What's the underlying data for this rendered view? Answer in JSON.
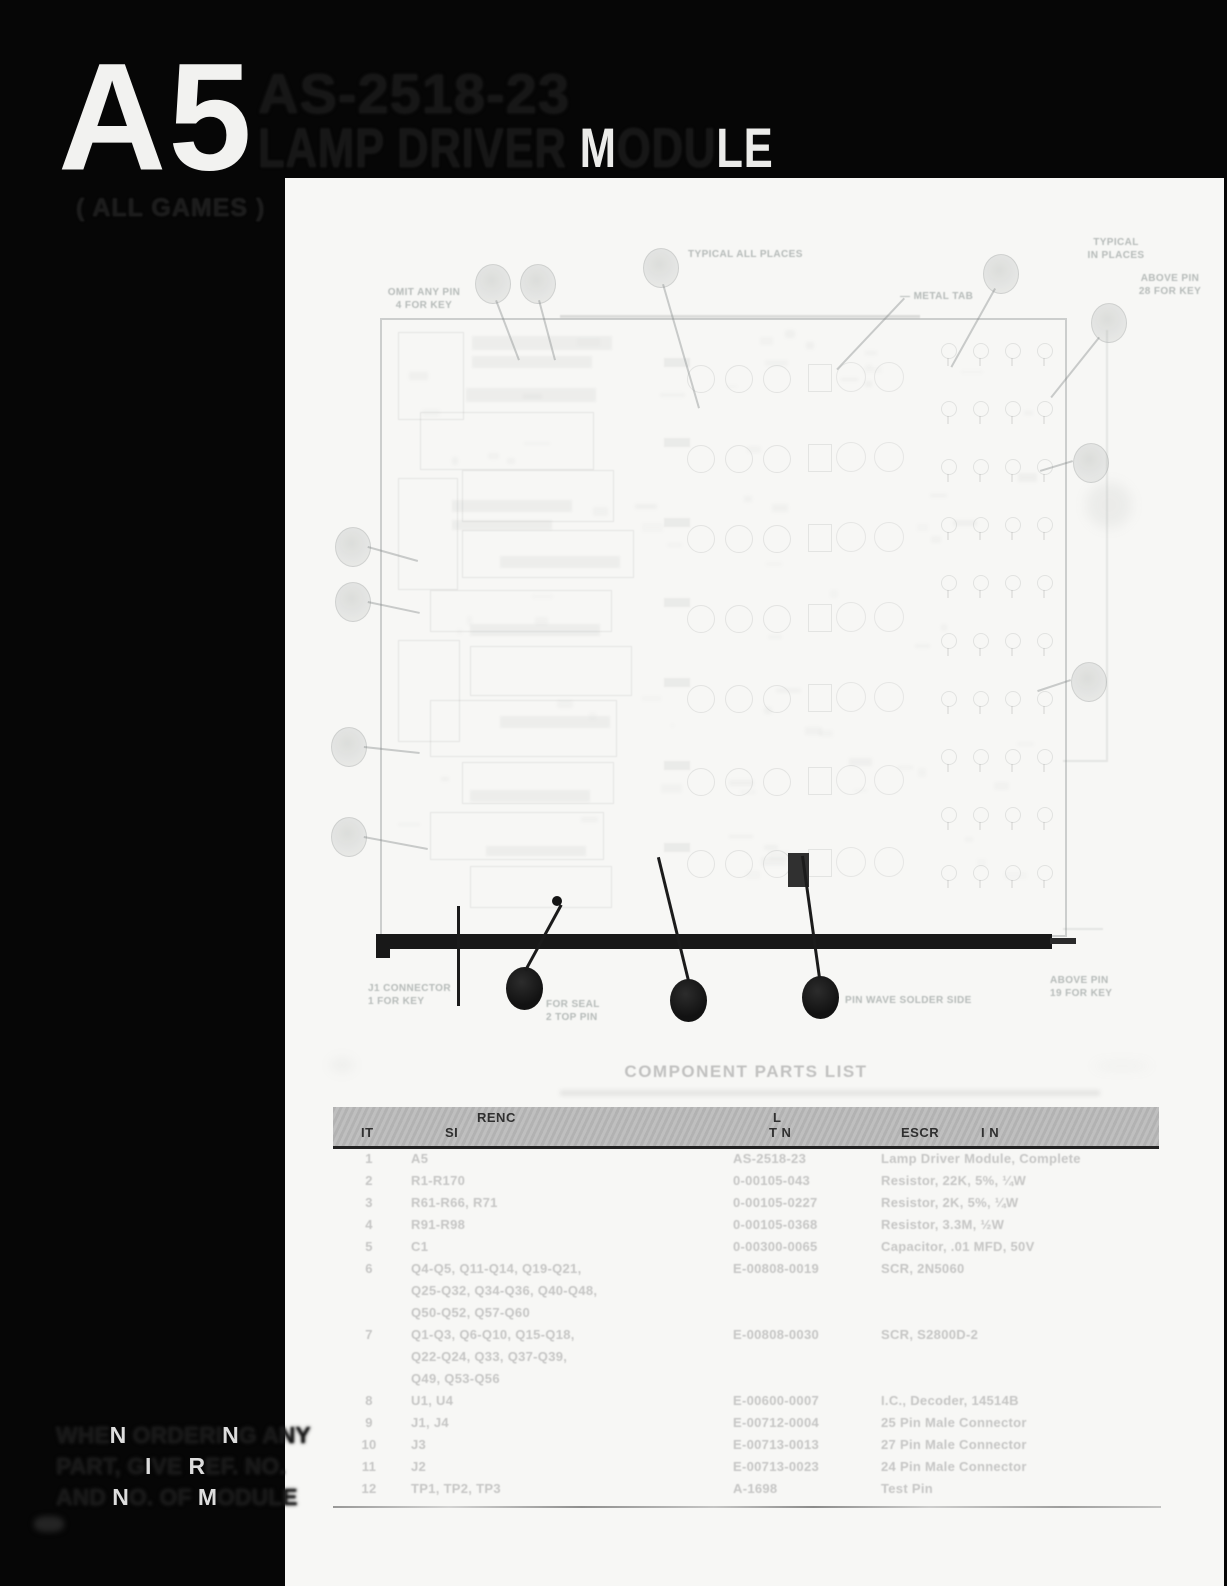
{
  "header": {
    "module_id": "A5",
    "title_line1": "AS-2518-23",
    "title_line2_segments": [
      {
        "text": "LAMP DRIVER ",
        "tone": "dark"
      },
      {
        "text": "M",
        "tone": "light"
      },
      {
        "text": "ODU",
        "tone": "dark"
      },
      {
        "text": "LE",
        "tone": "light"
      }
    ],
    "subtitle": "( ALL GAMES )"
  },
  "margin_note": {
    "line_segments": [
      [
        {
          "text": "WHE",
          "tone": "dark"
        },
        {
          "text": "N",
          "tone": "light"
        },
        {
          "text": " ORDERI",
          "tone": "dark"
        },
        {
          "text": "N",
          "tone": "light"
        },
        {
          "text": "G ANY",
          "tone": "dark"
        }
      ],
      [
        {
          "text": "PART, G",
          "tone": "dark"
        },
        {
          "text": "I",
          "tone": "light"
        },
        {
          "text": "VE ",
          "tone": "dark"
        },
        {
          "text": "R",
          "tone": "light"
        },
        {
          "text": "EF. NO.",
          "tone": "dark"
        }
      ],
      [
        {
          "text": "AND ",
          "tone": "dark"
        },
        {
          "text": "N",
          "tone": "light"
        },
        {
          "text": "O. OF ",
          "tone": "dark"
        },
        {
          "text": "M",
          "tone": "light"
        },
        {
          "text": "ODULE",
          "tone": "dark"
        }
      ]
    ]
  },
  "diagram": {
    "callout_labels": [
      {
        "id": "omit-pin-key",
        "lines": [
          "OMIT ANY PIN",
          "4 FOR KEY"
        ]
      },
      {
        "id": "typical-places",
        "lines": [
          "TYPICAL ALL PLACES"
        ]
      },
      {
        "id": "metal-tab",
        "lines": [
          "— METAL TAB"
        ]
      },
      {
        "id": "typical-in-places",
        "lines": [
          "TYPICAL",
          "IN PLACES"
        ]
      },
      {
        "id": "above-pin-top",
        "lines": [
          "ABOVE PIN",
          "28 FOR KEY"
        ]
      },
      {
        "id": "connector-key",
        "lines": [
          "J1 CONNECTOR",
          "1 FOR KEY"
        ]
      },
      {
        "id": "seal-pin",
        "lines": [
          "FOR SEAL",
          "2 TOP PIN"
        ]
      },
      {
        "id": "wave-solder",
        "lines": [
          "PIN WAVE SOLDER SIDE"
        ]
      },
      {
        "id": "above-pin-bottom",
        "lines": [
          "ABOVE PIN",
          "19 FOR KEY"
        ]
      }
    ]
  },
  "parts_list": {
    "heading": "COMPONENT PARTS LIST",
    "header_fragments": {
      "item": "IT",
      "ref_top": "RENC",
      "ref_bottom": "SI",
      "part_top": "L",
      "part_bottom": "T N",
      "desc_a": "ESCR",
      "desc_b": "I N"
    },
    "rows": [
      {
        "item": "1",
        "ref_lines": [
          "A5"
        ],
        "part": "AS-2518-23",
        "desc": "Lamp Driver Module, Complete"
      },
      {
        "item": "2",
        "ref_lines": [
          "R1-R170"
        ],
        "part": "0-00105-043",
        "desc": "Resistor, 22K, 5%, ¼W"
      },
      {
        "item": "3",
        "ref_lines": [
          "R61-R66, R71"
        ],
        "part": "0-00105-0227",
        "desc": "Resistor, 2K, 5%, ¼W"
      },
      {
        "item": "4",
        "ref_lines": [
          "R91-R98"
        ],
        "part": "0-00105-0368",
        "desc": "Resistor, 3.3M, ½W"
      },
      {
        "item": "5",
        "ref_lines": [
          "C1"
        ],
        "part": "0-00300-0065",
        "desc": "Capacitor, .01 MFD, 50V"
      },
      {
        "item": "6",
        "ref_lines": [
          "Q4-Q5, Q11-Q14, Q19-Q21,",
          "Q25-Q32, Q34-Q36, Q40-Q48,",
          "Q50-Q52, Q57-Q60"
        ],
        "part": "E-00808-0019",
        "desc": "SCR, 2N5060"
      },
      {
        "item": "7",
        "ref_lines": [
          "Q1-Q3, Q6-Q10, Q15-Q18,",
          "Q22-Q24, Q33, Q37-Q39,",
          "Q49, Q53-Q56"
        ],
        "part": "E-00808-0030",
        "desc": "SCR, S2800D-2"
      },
      {
        "item": "8",
        "ref_lines": [
          "U1, U4"
        ],
        "part": "E-00600-0007",
        "desc": "I.C., Decoder, 14514B"
      },
      {
        "item": "9",
        "ref_lines": [
          "J1, J4"
        ],
        "part": "E-00712-0004",
        "desc": "25 Pin Male Connector"
      },
      {
        "item": "10",
        "ref_lines": [
          "J3"
        ],
        "part": "E-00713-0013",
        "desc": "27 Pin Male Connector"
      },
      {
        "item": "11",
        "ref_lines": [
          "J2"
        ],
        "part": "E-00713-0023",
        "desc": "24 Pin Male Connector"
      },
      {
        "item": "12",
        "ref_lines": [
          "TP1, TP2, TP3"
        ],
        "part": "A-1698",
        "desc": "Test Pin"
      }
    ]
  },
  "colors": {
    "scan_black": "#060606",
    "paper_white": "#f7f7f5",
    "faded_ink": "#c6c6c5",
    "table_header_gray": "#bcbcbc",
    "balloon_black": "#121212"
  }
}
